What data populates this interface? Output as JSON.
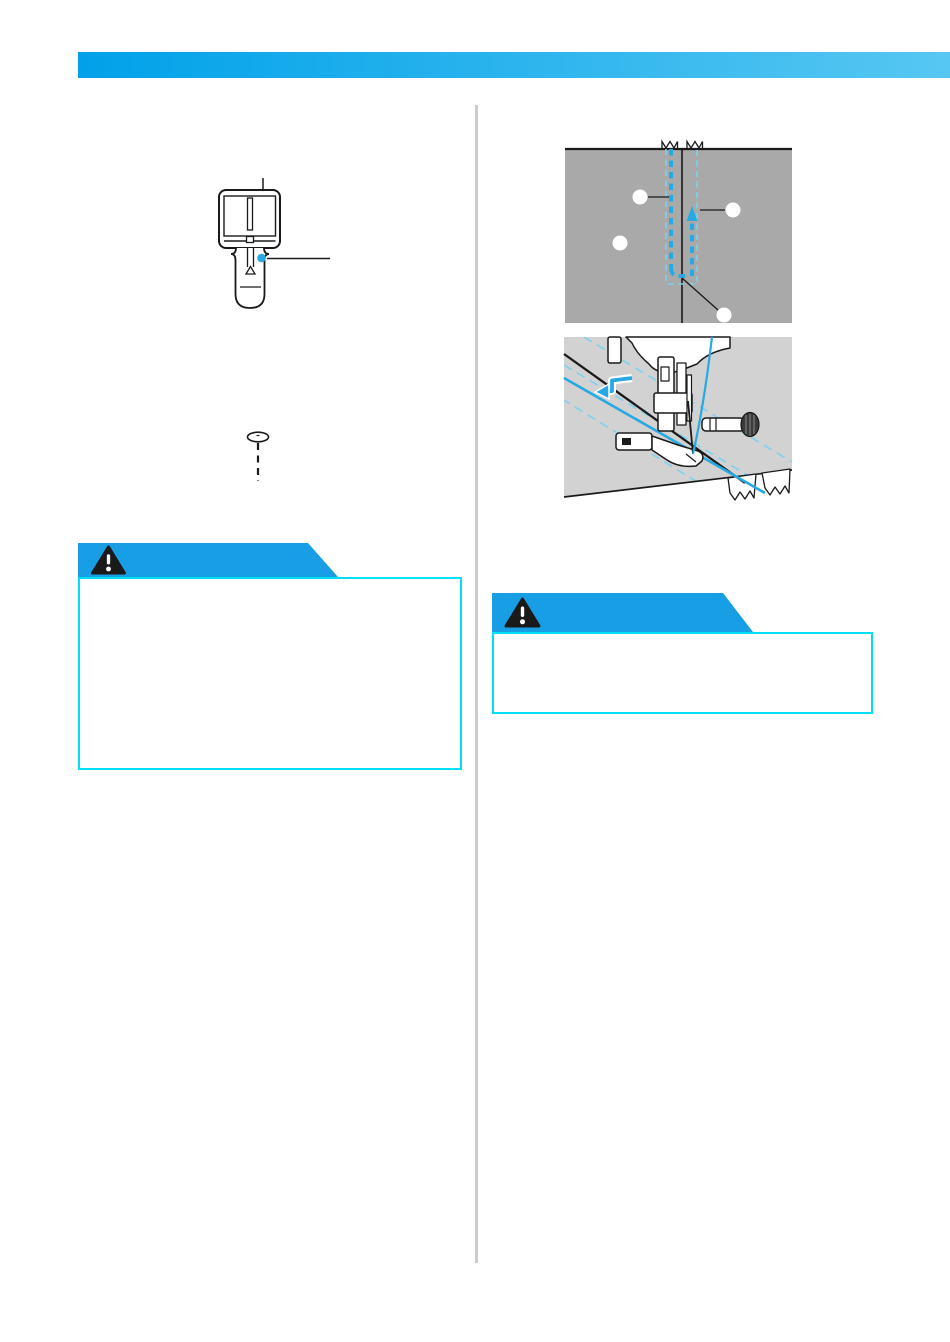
{
  "colors": {
    "header_a": "#00a1e9",
    "header_b": "#57c7f2",
    "banner_blue": "#189ee5",
    "cyan_border": "#00dff5",
    "fabric_gray": "#a9a9a9",
    "photo_gray": "#d2d2d2",
    "stitch_blue": "#29a9e2",
    "guide_blue": "#7ed1f0",
    "divider_gray": "#cdcdcd",
    "ink": "#1a1a1a",
    "dot_blue": "#29abe2"
  },
  "cautions": [
    {
      "icon": "warning-triangle",
      "label": ""
    },
    {
      "icon": "warning-triangle",
      "label": ""
    }
  ],
  "figures": {
    "presser_foot_top_view": {
      "callout_lines": 2,
      "pin_marker_dot": 1
    },
    "pin_icon": {
      "style": "dashed-shaft"
    },
    "basting_diagram": {
      "callout_circles": 4,
      "zigzag_notches": 2,
      "stitch_arrow_direction": "up"
    },
    "sewing_illustration": {
      "reverse_arrow": 1,
      "fabric_tails": 2
    }
  }
}
